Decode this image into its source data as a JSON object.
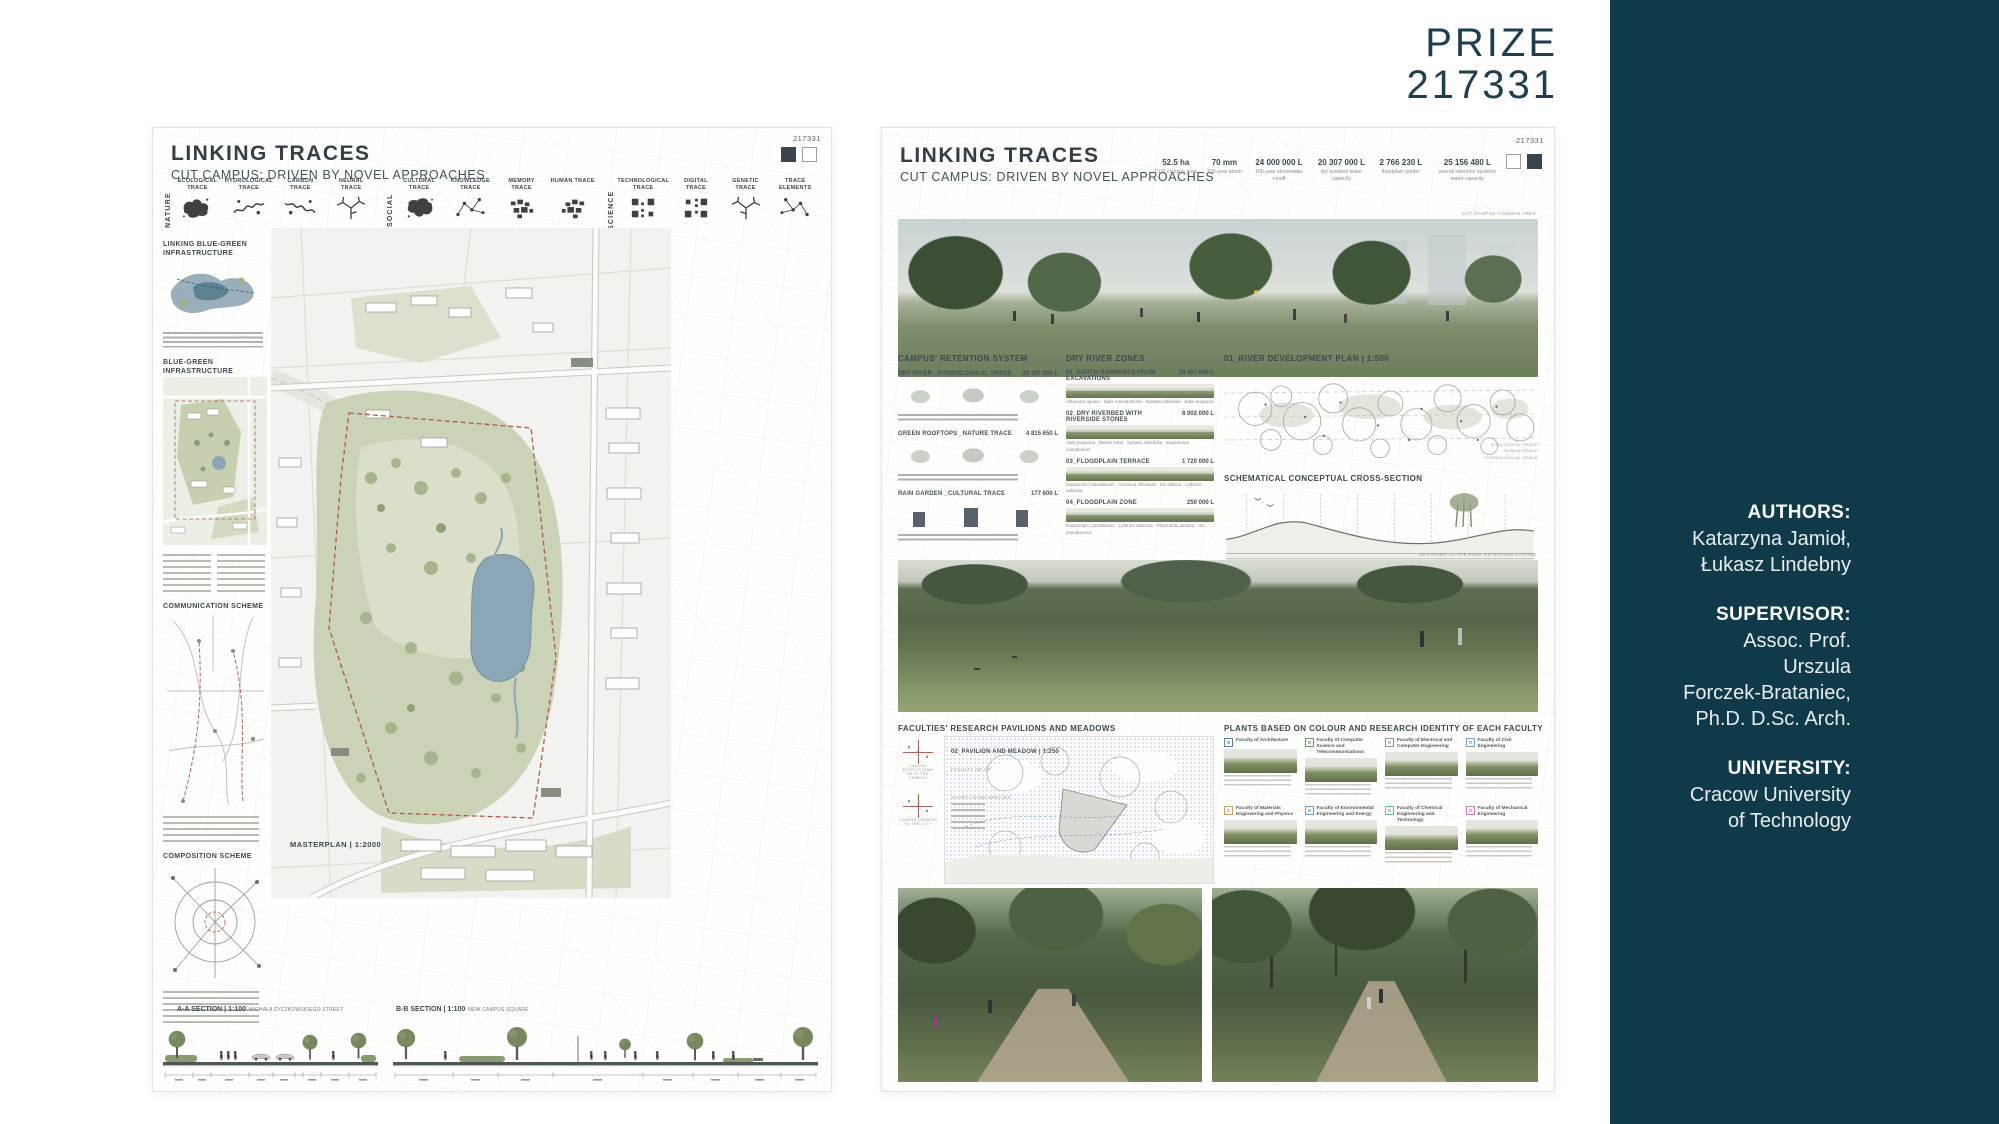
{
  "prize": {
    "label": "PRIZE",
    "number": "217331",
    "color": "#1e3e4e"
  },
  "sidebar": {
    "bg": "#0f3a49",
    "groups": [
      {
        "label": "AUTHORS:",
        "lines": [
          "Katarzyna Jamioł,",
          "Łukasz Lindebny"
        ]
      },
      {
        "label": "SUPERVISOR:",
        "lines": [
          "Assoc. Prof.",
          "Urszula",
          "Forczek-Brataniec,",
          "Ph.D. D.Sc. Arch."
        ]
      },
      {
        "label": "UNIVERSITY:",
        "lines": [
          "Cracow University",
          "of Technology"
        ]
      }
    ]
  },
  "poster_left": {
    "code": "217331",
    "title": "LINKING TRACES",
    "subtitle": "CUT CAMPUS: DRIVEN BY NOVEL APPROACHES",
    "trace_groups": [
      {
        "group": "NATURE",
        "items": [
          "ECOLOGICAL TRACE",
          "HYDROLOGICAL TRACE",
          "CARBON TRACE",
          "NEURAL TRACE"
        ]
      },
      {
        "group": "SOCIAL",
        "items": [
          "CULTURAL TRACE",
          "KNOWLEDGE TRACE",
          "MEMORY TRACE",
          "HUMAN TRACE"
        ]
      },
      {
        "group": "SCIENCE",
        "items": [
          "TECHNOLOGICAL TRACE",
          "DIGITAL TRACE",
          "GENETIC TRACE",
          "TRACE ELEMENTS"
        ]
      }
    ],
    "side_sections": [
      "LINKING BLUE-GREEN INFRASTRUCTURE",
      "BLUE-GREEN INFRASTRUCTURE",
      "COMMUNICATION SCHEME",
      "COMPOSITION SCHEME"
    ],
    "masterplan_label": "MASTERPLAN | 1:2000",
    "sections": [
      {
        "label": "A-A SECTION | 1:100",
        "sub": "MICHAŁA ŻYCZKOWSKIEGO STREET"
      },
      {
        "label": "B-B SECTION | 1:100",
        "sub": "NEW CAMPUS SQUARE"
      }
    ]
  },
  "poster_right": {
    "code": "217331",
    "title": "LINKING TRACES",
    "subtitle": "CUT CAMPUS: DRIVEN BY NOVEL APPROACHES",
    "stats": [
      {
        "value": "52.5 ha",
        "caption": "CUT campus area"
      },
      {
        "value": "70 mm",
        "caption": "100-year storm"
      },
      {
        "value": "24 000 000 L",
        "caption": "100-year stormwater runoff"
      },
      {
        "value": "20 307 000 L",
        "caption": "dry riverbed water capacity"
      },
      {
        "value": "2 766 230 L",
        "caption": "floodplain polder"
      },
      {
        "value": "25 156 480 L",
        "caption": "overall retention systems water capacity"
      }
    ],
    "top_photo_label": "CUT CAMPUS COMMON AREA",
    "retention": {
      "heading": "CAMPUS' RETENTION SYSTEM",
      "items": [
        {
          "label": "DRY RIVER _HYDROLOGICAL TRACE",
          "value": "20 307 000 L"
        },
        {
          "label": "GREEN ROOFTOPS _NATURE TRACE",
          "value": "4 815 650 L"
        },
        {
          "label": "RAIN GARDEN _CULTURAL TRACE",
          "value": "177 600 L"
        }
      ]
    },
    "zones": {
      "heading": "DRY RIVER ZONES",
      "items": [
        {
          "label": "01_EARTH RAMPARTS FROM EXCAVATIONS",
          "value": "20 307 000 L",
          "species": "Viburnum opulus · Salix rosmarinifolia · Spiraea salicifolia · Salix purpurea"
        },
        {
          "label": "02_DRY RIVERBED WITH RIVERSIDE STONES",
          "value": "8 002 000 L",
          "species": "Salix purpurea · Betula nana · Spiraea salicifolia · Eupatorium cannabinum"
        },
        {
          "label": "03_FLOODPLAIN TERRACE",
          "value": "1 720 000 L",
          "species": "Eupatorium cannabinum · Veronica officinalis · Iris sibirica · Lythrum salicaria"
        },
        {
          "label": "04_FLOODPLAIN ZONE",
          "value": "250 000 L",
          "species": "Eupatorium cannabinum · Lythrum salicaria · Filipendula ulmaria · Iris pseudacorus"
        }
      ]
    },
    "river_plan": {
      "heading": "01_RIVER DEVELOPMENT PLAN | 1:500",
      "cross_section": "SCHEMATICAL CONCEPTUAL CROSS-SECTION",
      "tags": [
        "ECOLOGICAL TRACE",
        "HUMAN TRACE",
        "HYDROLOGICAL TRACE"
      ]
    },
    "mid_photo_label": "DRY RIVER AS THE PARK RETENTION SYSTEM",
    "pavilions": {
      "heading": "FACULTIES' RESEARCH PAVILIONS AND MEADOWS",
      "plan_label": "02_PAVILION AND MEADOW | 1:250",
      "plan_sub": "FACULTY OF ARCHITECTURE",
      "species_label": "SHORTLISTED SPECIES",
      "notes": [
        "LINKING ECOSYSTEMS WITH THE CAMPUS",
        "LINKING CAMPUS TO THE CITY"
      ]
    },
    "plants": {
      "heading": "PLANTS BASED ON COLOUR AND RESEARCH IDENTITY OF EACH FACULTY",
      "faculties": [
        {
          "name": "Faculty of Architecture",
          "color": "#5b87ae"
        },
        {
          "name": "Faculty of Computer Science and Telecommunications",
          "color": "#63a558"
        },
        {
          "name": "Faculty of Electrical and Computer Engineering",
          "color": "#a87fc0"
        },
        {
          "name": "Faculty of Civil Engineering",
          "color": "#7ca3cc"
        },
        {
          "name": "Faculty of Materials Engineering and Physics",
          "color": "#d89a66"
        },
        {
          "name": "Faculty of Environmental Engineering and Energy",
          "color": "#5f9fc2"
        },
        {
          "name": "Faculty of Chemical Engineering and Technology",
          "color": "#5fbfae"
        },
        {
          "name": "Faculty of Mechanical Engineering",
          "color": "#d678ae"
        }
      ]
    }
  }
}
